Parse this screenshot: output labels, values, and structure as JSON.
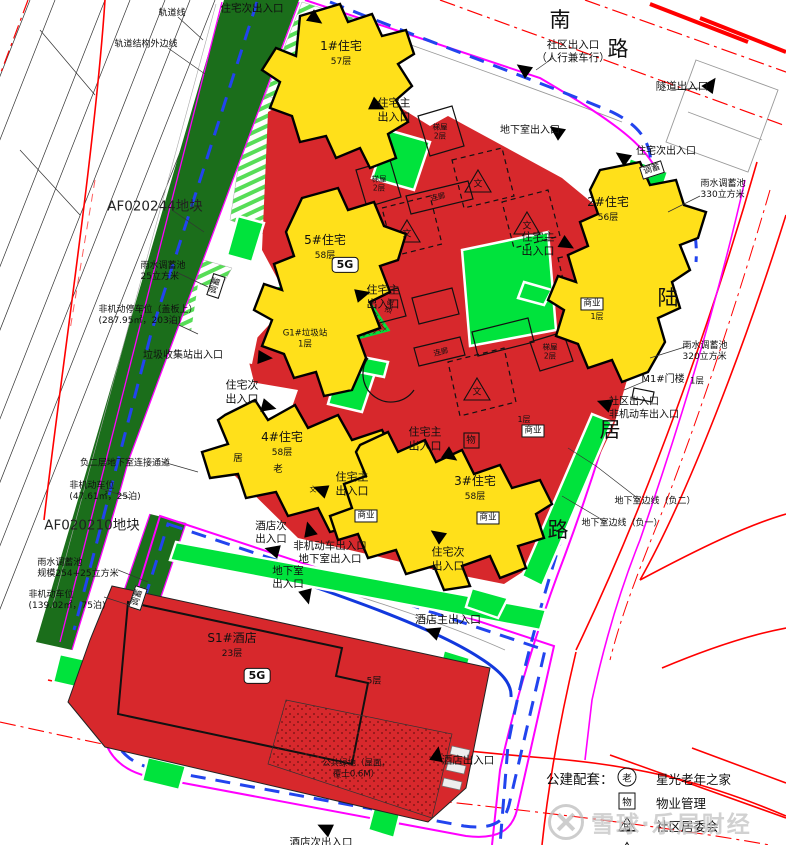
{
  "roads": {
    "south": {
      "c1": "南",
      "c2": "路"
    },
    "luju": {
      "c1": "陆",
      "c2": "居",
      "c3": "路"
    }
  },
  "plots": {
    "p244": "AF020244地块",
    "p210": "AF020210地块"
  },
  "buildings": {
    "t1": {
      "name": "1#住宅",
      "floors": "57层"
    },
    "t2": {
      "name": "2#住宅",
      "floors": "56层"
    },
    "t3": {
      "name": "3#住宅",
      "floors": "58层"
    },
    "t4": {
      "name": "4#住宅",
      "floors": "58层"
    },
    "t5": {
      "name": "5#住宅",
      "floors": "58层"
    },
    "hotel": {
      "name": "S1#酒店",
      "floors": "23层"
    },
    "hotel_podium": "5层",
    "garbage": "G1#垃圾站\n1层",
    "gate": "M1#门楼",
    "gate_floors": "1层"
  },
  "rooms": {
    "stair": "梯屋\n2层",
    "corridor": "连廊",
    "biz": "商业",
    "floor1": "1层",
    "culture": "文",
    "property": "物",
    "elder": "老",
    "community": "居"
  },
  "badges": {
    "g5": "5G",
    "storage": "调蓄"
  },
  "entrances": {
    "res_main": "住宅主\n出入口",
    "res_sub": "住宅次出入口",
    "res_sub2": "住宅次\n出入口",
    "community_top": "社区出入口\n（人行兼车行）",
    "community_right": "社区出入口\n非机动车出入口",
    "tunnel": "隧道出入口",
    "basement": "地下室出入口",
    "basement2": "地下室\n出入口",
    "nonmotor_basement": "非机动车出入口\n地下室出入口",
    "hotel_main": "酒店主出入口",
    "hotel_sub2": "酒店次\n出入口",
    "hotel_gate": "酒店出入口",
    "hotel_sub_bottom": "酒店次出入口",
    "garbage_gate": "垃圾收集站出入口"
  },
  "annotations": {
    "rail": "轨道线",
    "rail_struct": "轨道结构外边线",
    "rain25": "雨水调蓄池\n25立方米",
    "bike_cover": "非机动停车位（盖板上）\n(287.95㎡，203泊)",
    "bike25": "非机动车位\n(47.61㎡，25泊)",
    "rain254": "雨水调蓄池\n规模254+25立方米",
    "bike75": "非机动车位\n(139.02㎡，75泊)",
    "link": "负二层地下室连接通道",
    "rain330": "雨水调蓄池\n330立方米",
    "rain320": "雨水调蓄池\n320立方米",
    "bl2": "地下室边线（负二）",
    "bl1": "地下室边线（负一）",
    "green_roof": "公共绿地（屋面，\n覆土0.6M）"
  },
  "legend": {
    "title": "公建配套：",
    "items": [
      {
        "symbol": "老",
        "shape": "circle",
        "label": "星光老年之家"
      },
      {
        "symbol": "物",
        "shape": "square",
        "label": "物业管理"
      },
      {
        "symbol": "居",
        "shape": "triangle",
        "label": "社区居委会"
      },
      {
        "symbol": "文",
        "shape": "triangle",
        "label": "文化室"
      }
    ]
  },
  "watermark": {
    "text": "雪球·乐居财经",
    "logo_icon": "xueqiu-logo"
  },
  "colors": {
    "podium": "#D7282C",
    "tower": "#FFE01A",
    "green": "#00E33C",
    "park": "#1B6E1B",
    "boundary": "#FF00FF",
    "guide": "#2244EE",
    "road": "#FF0000"
  }
}
